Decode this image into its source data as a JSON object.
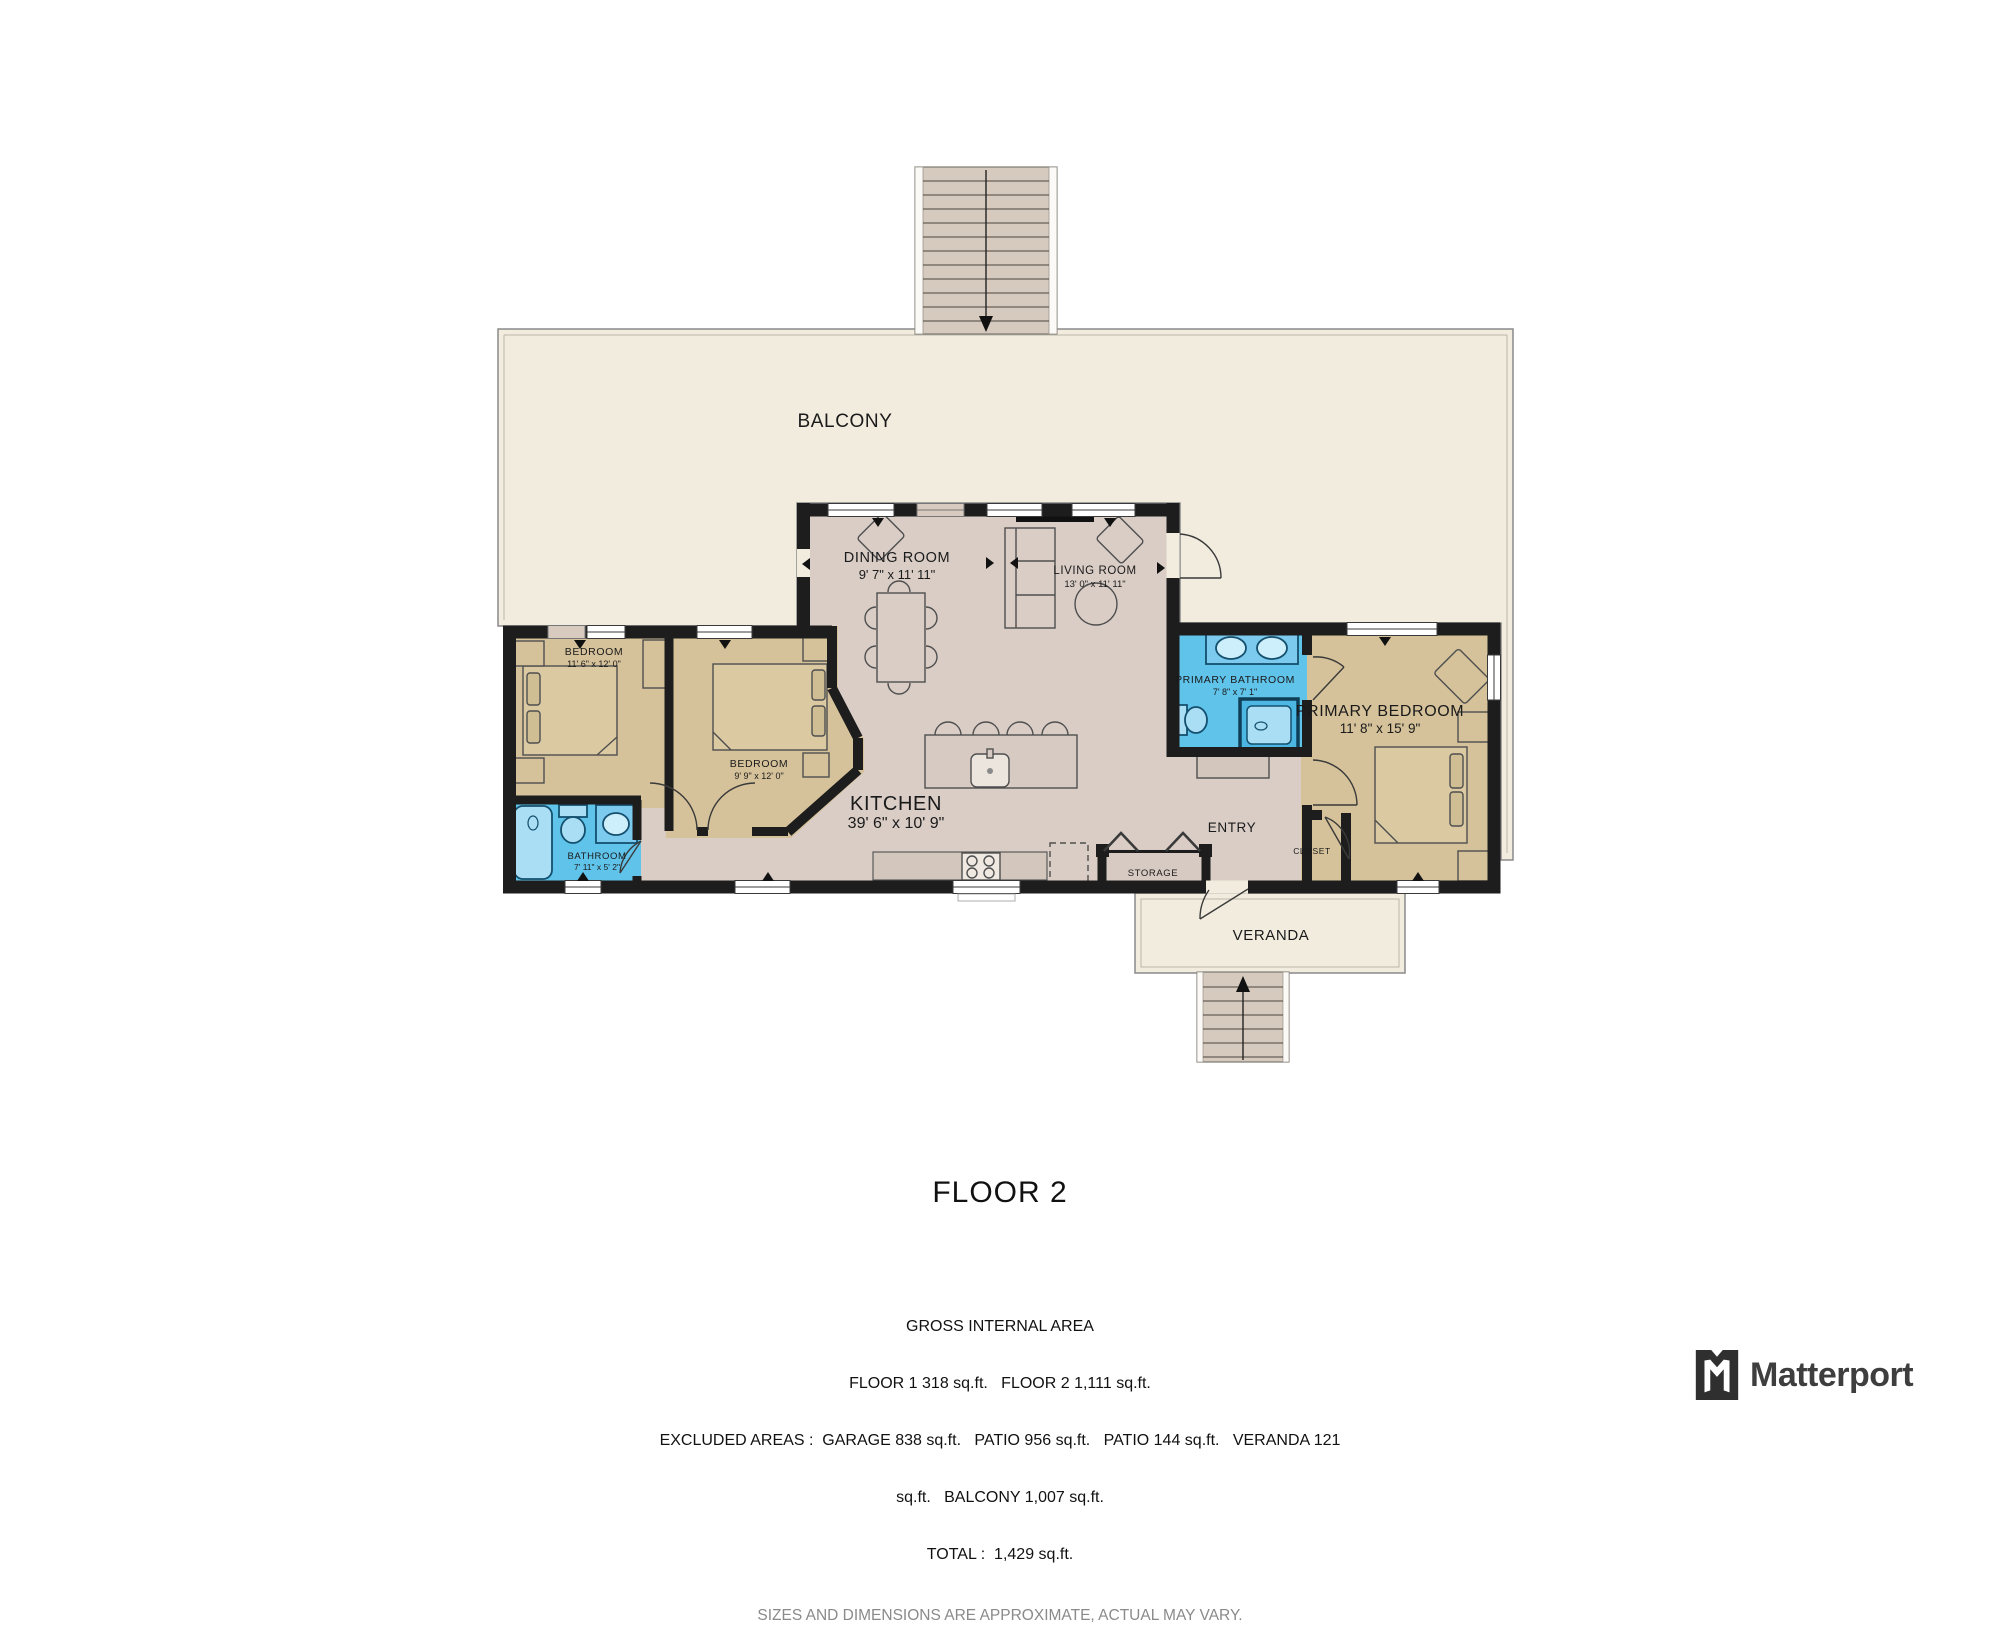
{
  "floor_plan": {
    "title": "FLOOR 2",
    "rooms": {
      "balcony": {
        "label": "BALCONY"
      },
      "dining_room": {
        "label": "DINING ROOM",
        "dims": "9' 7\" x 11' 11\""
      },
      "living_room": {
        "label": "LIVING ROOM",
        "dims": "13' 0\" x 11' 11\""
      },
      "bedroom_left": {
        "label": "BEDROOM",
        "dims": "11' 6\" x 12' 0\""
      },
      "bedroom_middle": {
        "label": "BEDROOM",
        "dims": "9' 9\" x 12' 0\""
      },
      "bathroom": {
        "label": "BATHROOM",
        "dims": "7' 11\" x 5' 2\""
      },
      "kitchen": {
        "label": "KITCHEN",
        "dims": "39' 6\" x 10' 9\""
      },
      "primary_bathroom": {
        "label": "PRIMARY BATHROOM",
        "dims": "7' 8\" x 7' 1\""
      },
      "primary_bedroom": {
        "label": "PRIMARY BEDROOM",
        "dims": "11' 8\" x 15' 9\""
      },
      "entry": {
        "label": "ENTRY"
      },
      "closet": {
        "label": "CLOSET"
      },
      "storage": {
        "label": "STORAGE"
      },
      "veranda": {
        "label": "VERANDA"
      }
    },
    "summary": {
      "line1": "GROSS INTERNAL AREA",
      "line2": "FLOOR 1 318 sq.ft.   FLOOR 2 1,111 sq.ft.",
      "line3": "EXCLUDED AREAS :  GARAGE 838 sq.ft.   PATIO 956 sq.ft.   PATIO 144 sq.ft.   VERANDA 121",
      "line4": "sq.ft.   BALCONY 1,007 sq.ft.",
      "line5": "TOTAL :  1,429 sq.ft.",
      "disclaimer": "SIZES AND DIMENSIONS ARE APPROXIMATE, ACTUAL MAY VARY."
    },
    "brand": "Matterport",
    "colors": {
      "outdoor_floor": "#f2ecdf",
      "interior_floor": "#d9cdc6",
      "bedroom_floor": "#d5c29a",
      "bathroom_floor": "#5fc3ea",
      "wall": "#1d1d1d",
      "stairs": "#d6c9be"
    }
  }
}
